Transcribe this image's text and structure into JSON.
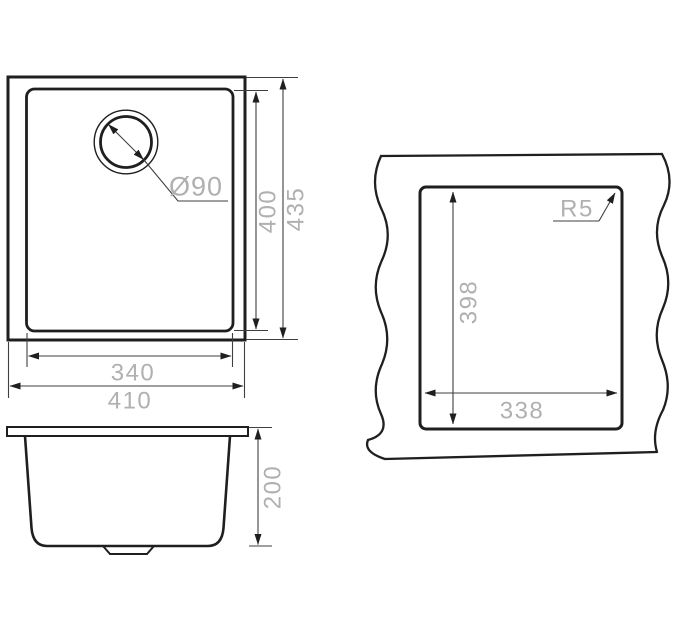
{
  "top_view": {
    "drain_diameter": "Ø90",
    "bowl_height_dim": "400",
    "overall_height_dim": "435",
    "bowl_width_dim": "340",
    "overall_width_dim": "410"
  },
  "side_view": {
    "depth_dim": "200"
  },
  "cutout_view": {
    "corner_radius": "R5",
    "cutout_height_dim": "398",
    "cutout_width_dim": "338"
  },
  "colors": {
    "outline": "#1f1f1f",
    "dimension_line": "#3f3f3f",
    "label": "#b0b0b0",
    "background": "#ffffff"
  }
}
